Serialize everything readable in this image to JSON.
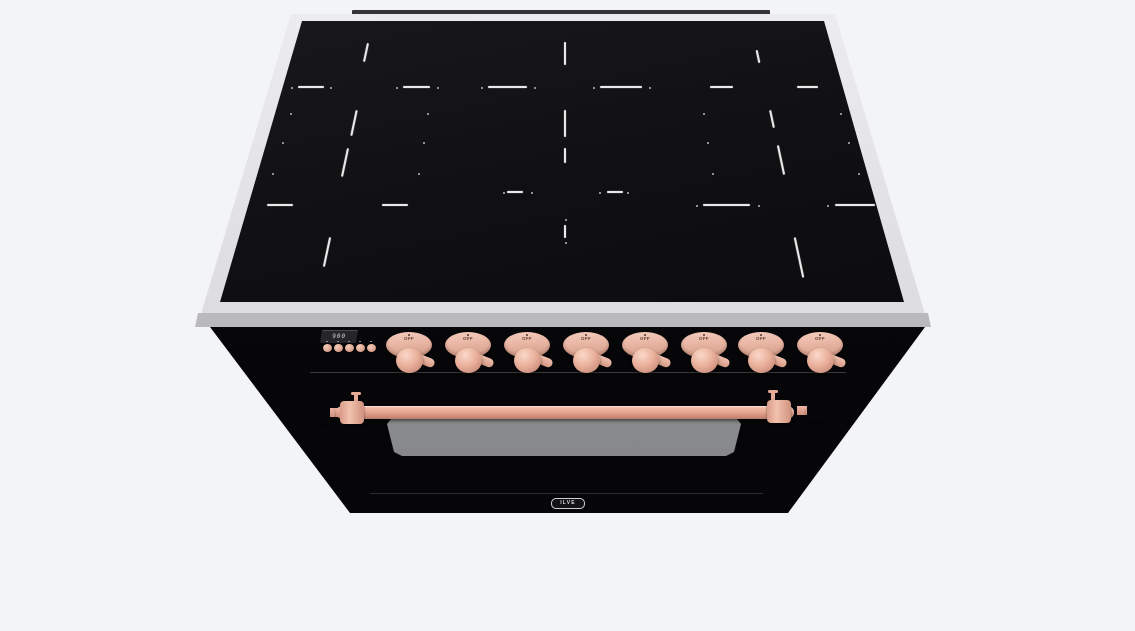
{
  "colors": {
    "background": "#f3f4f6",
    "frame_steel": "#dedee0",
    "glass_black": "#0a0a0c",
    "body_black": "#060608",
    "copper": "#e3a691",
    "oven_window_gray": "#95969a",
    "zone_marking": "#e9e9ea"
  },
  "cooktop": {
    "zone_dashes": [
      {
        "x": 298,
        "y": 86,
        "w": 26,
        "h": 2,
        "r": 0
      },
      {
        "x": 403,
        "y": 86,
        "w": 27,
        "h": 2,
        "r": 0
      },
      {
        "x": 365,
        "y": 43,
        "w": 2,
        "h": 19,
        "r": 12
      },
      {
        "x": 353,
        "y": 110,
        "w": 2,
        "h": 26,
        "r": 12
      },
      {
        "x": 267,
        "y": 204,
        "w": 26,
        "h": 2,
        "r": 0
      },
      {
        "x": 382,
        "y": 204,
        "w": 26,
        "h": 2,
        "r": 0
      },
      {
        "x": 344,
        "y": 148,
        "w": 2,
        "h": 29,
        "r": 12
      },
      {
        "x": 326,
        "y": 237,
        "w": 2,
        "h": 30,
        "r": 12
      },
      {
        "x": 488,
        "y": 86,
        "w": 39,
        "h": 2,
        "r": 0
      },
      {
        "x": 600,
        "y": 86,
        "w": 42,
        "h": 2,
        "r": 0
      },
      {
        "x": 564,
        "y": 42,
        "w": 2,
        "h": 23,
        "r": 0
      },
      {
        "x": 564,
        "y": 110,
        "w": 2,
        "h": 27,
        "r": 0
      },
      {
        "x": 507,
        "y": 191,
        "w": 16,
        "h": 2,
        "r": 0
      },
      {
        "x": 607,
        "y": 191,
        "w": 16,
        "h": 2,
        "r": 0
      },
      {
        "x": 564,
        "y": 148,
        "w": 2,
        "h": 15,
        "r": 0
      },
      {
        "x": 564,
        "y": 225,
        "w": 2,
        "h": 13,
        "r": 0
      },
      {
        "x": 710,
        "y": 86,
        "w": 23,
        "h": 2,
        "r": 0
      },
      {
        "x": 797,
        "y": 86,
        "w": 21,
        "h": 2,
        "r": 0
      },
      {
        "x": 757,
        "y": 50,
        "w": 2,
        "h": 13,
        "r": -12
      },
      {
        "x": 771,
        "y": 110,
        "w": 2,
        "h": 18,
        "r": -12
      },
      {
        "x": 703,
        "y": 204,
        "w": 47,
        "h": 2,
        "r": 0
      },
      {
        "x": 835,
        "y": 204,
        "w": 40,
        "h": 2,
        "r": 0
      },
      {
        "x": 780,
        "y": 145,
        "w": 2,
        "h": 30,
        "r": -12
      },
      {
        "x": 798,
        "y": 237,
        "w": 2,
        "h": 41,
        "r": -12
      }
    ],
    "zone_dots": [
      [
        290,
        113
      ],
      [
        427,
        113
      ],
      [
        282,
        142
      ],
      [
        423,
        142
      ],
      [
        272,
        173
      ],
      [
        418,
        173
      ],
      [
        703,
        113
      ],
      [
        840,
        113
      ],
      [
        707,
        142
      ],
      [
        848,
        142
      ],
      [
        712,
        173
      ],
      [
        858,
        173
      ],
      [
        503,
        192
      ],
      [
        531,
        192
      ],
      [
        599,
        192
      ],
      [
        627,
        192
      ],
      [
        565,
        219
      ],
      [
        565,
        242
      ],
      [
        481,
        87
      ],
      [
        534,
        87
      ],
      [
        593,
        87
      ],
      [
        649,
        87
      ],
      [
        291,
        87
      ],
      [
        330,
        87
      ],
      [
        396,
        87
      ],
      [
        437,
        87
      ],
      [
        696,
        205
      ],
      [
        758,
        205
      ],
      [
        827,
        205
      ],
      [
        881,
        205
      ]
    ]
  },
  "control_panel": {
    "display_value": "900",
    "button_centers_x": [
      327,
      338,
      349,
      360,
      371
    ],
    "knobs": [
      {
        "label": "OFF",
        "cx": 409
      },
      {
        "label": "OFF",
        "cx": 468
      },
      {
        "label": "OFF",
        "cx": 527
      },
      {
        "label": "OFF",
        "cx": 586
      },
      {
        "label": "OFF",
        "cx": 645
      },
      {
        "label": "OFF",
        "cx": 704
      },
      {
        "label": "OFF",
        "cx": 761
      },
      {
        "label": "OFF",
        "cx": 820
      }
    ]
  },
  "oven": {
    "logo_text": "ILVE"
  }
}
